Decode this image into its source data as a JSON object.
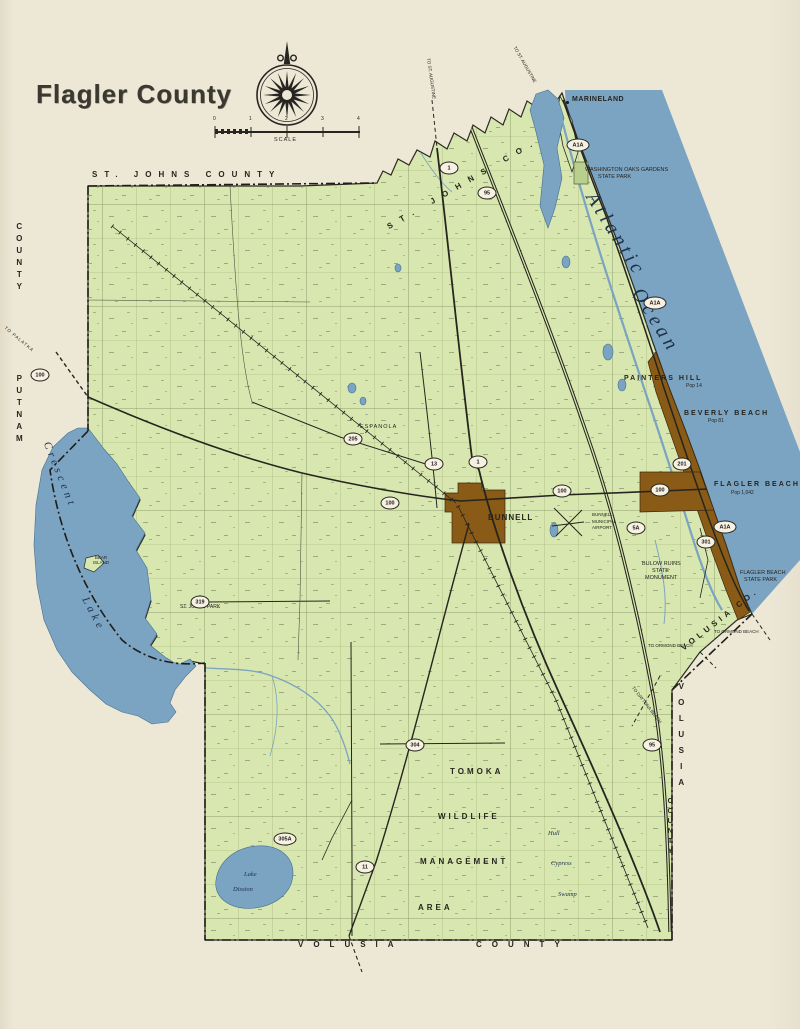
{
  "title": "Flagler County",
  "scale": {
    "label": "SCALE",
    "t0": "0",
    "t1": "1",
    "t2": "2",
    "t3": "3",
    "t4": "4"
  },
  "borders": {
    "st_johns_top": "ST.  JOHNS  COUNTY",
    "st_johns_diag": "ST.  JOHNS  CO.",
    "left_county": "COUNTY",
    "left_putnam": "PUTNAM",
    "volusia_bottom_1": "VOLUSIA",
    "volusia_bottom_2": "COUNTY",
    "volusia_right_1": "VOLUSIA",
    "volusia_right_2": "COUNTY",
    "volusia_coast": "VOLUSIA  CO."
  },
  "water": {
    "atlantic": "Atlantic",
    "ocean": "Ocean",
    "crescent": "Crescent",
    "crescent_lake": "Lake",
    "disston_1": "Lake",
    "disston_2": "Disston",
    "bear_island": "BEAR ISLAND"
  },
  "places": {
    "marineland": "MARINELAND",
    "painters_hill": "PAINTERS  HILL",
    "painters_hill_pop": "Pop 14",
    "beverly_beach": "BEVERLY  BEACH",
    "beverly_beach_pop": "Pop 81",
    "flagler_beach": "FLAGLER  BEACH",
    "flagler_beach_pop": "Pop 1,042",
    "bunnell": "BUNNELL",
    "espanola": "ESPANOLA",
    "st_johns_park": "ST. JOHNS PARK"
  },
  "parks": {
    "wash_oaks_1": "WASHINGTON OAKS GARDENS",
    "wash_oaks_2": "STATE PARK",
    "fb_state_park_1": "FLAGLER BEACH",
    "fb_state_park_2": "STATE PARK",
    "bulow_1": "BULOW RUINS",
    "bulow_2": "STATE",
    "bulow_3": "MONUMENT",
    "tomoka_1": "TOMOKA",
    "tomoka_2": "WILDLIFE",
    "tomoka_3": "MANAGEMENT",
    "tomoka_4": "AREA",
    "hull": "Hull",
    "cypress": "Cypress",
    "swamp": "Swamp"
  },
  "airport": {
    "l1": "BUNNELL",
    "l2": "MUNICIPAL",
    "l3": "AIRPORT"
  },
  "directions": {
    "to_palatka": "TO PALATKA",
    "to_st_augustine_1": "TO ST. AUGUSTINE",
    "to_st_augustine_2": "TO ST. AUGUSTINE",
    "to_ormond_1": "TO ORMOND BEACH",
    "to_ormond_2": "TO ORMOND BEACH",
    "to_daytona": "TO DAYTONA BEACH"
  },
  "routes": [
    "1",
    "95",
    "A1A",
    "A1A",
    "A1A",
    "100",
    "100",
    "100",
    "100",
    "205",
    "13",
    "1",
    "5A",
    "201",
    "301",
    "11",
    "305A",
    "319",
    "304",
    "95"
  ],
  "colors": {
    "paper": "#EDE7D6",
    "land": "#D8E7AF",
    "water": "#7BA3C2",
    "beach_strip": "#8A5A17",
    "ink": "#26251f"
  }
}
